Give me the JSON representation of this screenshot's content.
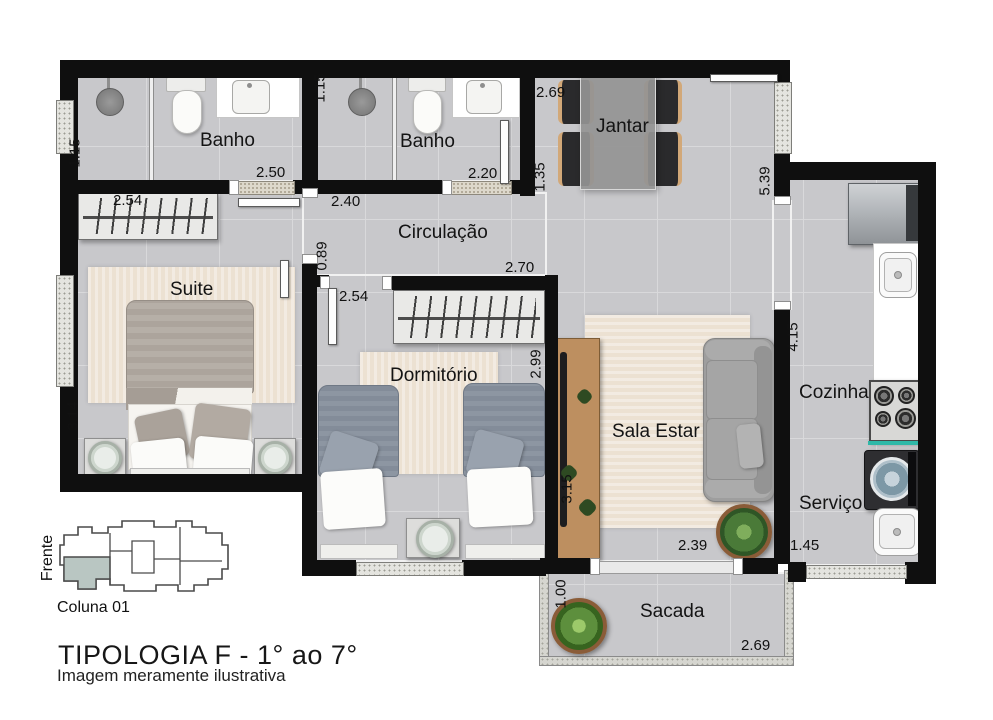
{
  "title": "TIPOLOGIA F - 1° ao 7°",
  "subtitle": "Imagem meramente ilustrativa",
  "keyplan": {
    "front": "Frente",
    "column": "Coluna 01",
    "highlight_color": "#b9c6c2"
  },
  "rooms": {
    "banho1": "Banho",
    "banho2": "Banho",
    "jantar": "Jantar",
    "circulacao": "Circulação",
    "suite": "Suite",
    "dormitorio": "Dormitório",
    "sala_estar": "Sala Estar",
    "cozinha": "Cozinha",
    "servico": "Serviço",
    "sacada": "Sacada"
  },
  "dimensions": {
    "banho1_depth": "1.15",
    "banho1_width": "2.50",
    "banho2_depth": "1.15",
    "banho2_width": "2.20",
    "jantar_width": "2.69",
    "jantar_depth": "1.35",
    "kitchen_wall": "5.39",
    "circulacao_width": "2.40",
    "suite_door": "0.89",
    "suite_closet": "2.54",
    "dorm_closet": "2.54",
    "dorm_width": "2.70",
    "dorm_depth": "2.99",
    "suite_depth": "3.14",
    "sala_rack": "3.15",
    "sala_width": "2.39",
    "cozinha_depth": "4.15",
    "servico_width": "1.45",
    "sacada_depth": "1.00",
    "sacada_width": "2.69"
  },
  "colors": {
    "wall": "#0f0f0f",
    "floor": "#c8c8cb",
    "accent_teal": "#2fb8a8",
    "rug": "#ece1d2",
    "wood": "#bd8f60",
    "keyplan_highlight": "#b9c6c2"
  }
}
